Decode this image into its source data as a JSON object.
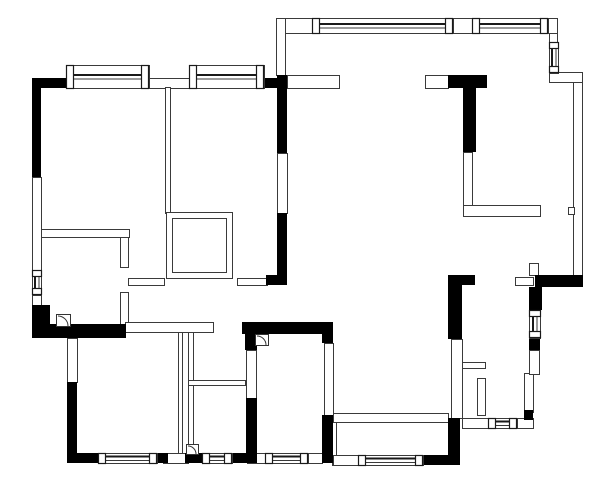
{
  "meta": {
    "kind": "architectural-floor-plan",
    "canvas": {
      "width": 600,
      "height": 483,
      "background": "#ffffff"
    },
    "colors": {
      "structural_wall": "#000000",
      "partition_line": "#3a3a3a",
      "window_glass": "#1a1a1a",
      "paper": "#ffffff"
    }
  },
  "floorplan": {
    "black_walls": [
      [
        32,
        78,
        9,
        99
      ],
      [
        32,
        78,
        36,
        10
      ],
      [
        263,
        78,
        20,
        10
      ],
      [
        277,
        75,
        10,
        78
      ],
      [
        277,
        213,
        10,
        72
      ],
      [
        266,
        275,
        21,
        10
      ],
      [
        448,
        75,
        39,
        13
      ],
      [
        463,
        88,
        13,
        64
      ],
      [
        32,
        305,
        18,
        33
      ],
      [
        32,
        324,
        94,
        14
      ],
      [
        242,
        322,
        91,
        12
      ],
      [
        245,
        334,
        12,
        16
      ],
      [
        246,
        398,
        11,
        65
      ],
      [
        322,
        334,
        11,
        9
      ],
      [
        322,
        415,
        11,
        48
      ],
      [
        67,
        382,
        10,
        81
      ],
      [
        67,
        453,
        31,
        10
      ],
      [
        157,
        453,
        11,
        10
      ],
      [
        185,
        453,
        17,
        10
      ],
      [
        232,
        453,
        15,
        10
      ],
      [
        448,
        275,
        27,
        10
      ],
      [
        448,
        275,
        14,
        64
      ],
      [
        448,
        418,
        12,
        47
      ],
      [
        423,
        455,
        35,
        10
      ],
      [
        535,
        275,
        48,
        12
      ],
      [
        529,
        287,
        13,
        23
      ],
      [
        529,
        338,
        11,
        12
      ],
      [
        524,
        410,
        9,
        10
      ]
    ],
    "thin_walls": [
      [
        32,
        177,
        9,
        94
      ],
      [
        32,
        295,
        9,
        12
      ],
      [
        148,
        78,
        42,
        10
      ],
      [
        165,
        87,
        5,
        126
      ],
      [
        166,
        212,
        66,
        66
      ],
      [
        172,
        218,
        54,
        54
      ],
      [
        41,
        229,
        88,
        8
      ],
      [
        120,
        237,
        8,
        30
      ],
      [
        120,
        292,
        8,
        33
      ],
      [
        128,
        278,
        36,
        7
      ],
      [
        237,
        278,
        30,
        7
      ],
      [
        276,
        18,
        36,
        15
      ],
      [
        276,
        18,
        9,
        57
      ],
      [
        453,
        18,
        19,
        15
      ],
      [
        548,
        18,
        9,
        15
      ],
      [
        549,
        33,
        8,
        10
      ],
      [
        549,
        72,
        33,
        10
      ],
      [
        573,
        82,
        9,
        194
      ],
      [
        568,
        207,
        6,
        7
      ],
      [
        287,
        75,
        52,
        13
      ],
      [
        425,
        75,
        23,
        13
      ],
      [
        463,
        152,
        9,
        56
      ],
      [
        463,
        205,
        77,
        11
      ],
      [
        277,
        153,
        10,
        60
      ],
      [
        125,
        322,
        88,
        10
      ],
      [
        188,
        332,
        5,
        125
      ],
      [
        188,
        380,
        57,
        5
      ],
      [
        178,
        332,
        4,
        125
      ],
      [
        163,
        453,
        25,
        10
      ],
      [
        247,
        453,
        18,
        10
      ],
      [
        308,
        453,
        14,
        10
      ],
      [
        333,
        413,
        115,
        9
      ],
      [
        332,
        422,
        4,
        43
      ],
      [
        333,
        455,
        25,
        10
      ],
      [
        458,
        362,
        27,
        6
      ],
      [
        451,
        339,
        11,
        79
      ],
      [
        477,
        378,
        8,
        37
      ],
      [
        524,
        373,
        9,
        39
      ],
      [
        462,
        418,
        71,
        10
      ],
      [
        529,
        350,
        10,
        24
      ],
      [
        515,
        277,
        18,
        8
      ],
      [
        529,
        263,
        9,
        12
      ],
      [
        67,
        338,
        10,
        44
      ],
      [
        246,
        350,
        10,
        48
      ],
      [
        324,
        343,
        9,
        72
      ]
    ],
    "windows": [
      {
        "x": 66,
        "y": 65,
        "w": 83,
        "h": 23,
        "orient": "h"
      },
      {
        "x": 189,
        "y": 65,
        "w": 75,
        "h": 23,
        "orient": "h"
      },
      {
        "x": 312,
        "y": 18,
        "w": 141,
        "h": 15,
        "orient": "h"
      },
      {
        "x": 472,
        "y": 18,
        "w": 76,
        "h": 15,
        "orient": "h"
      },
      {
        "x": 549,
        "y": 42,
        "w": 9,
        "h": 31,
        "orient": "v"
      },
      {
        "x": 32,
        "y": 270,
        "w": 9,
        "h": 25,
        "orient": "v"
      },
      {
        "x": 98,
        "y": 453,
        "w": 59,
        "h": 10,
        "orient": "h"
      },
      {
        "x": 202,
        "y": 453,
        "w": 30,
        "h": 10,
        "orient": "h"
      },
      {
        "x": 265,
        "y": 453,
        "w": 43,
        "h": 10,
        "orient": "h"
      },
      {
        "x": 358,
        "y": 455,
        "w": 65,
        "h": 10,
        "orient": "h"
      },
      {
        "x": 488,
        "y": 418,
        "w": 29,
        "h": 10,
        "orient": "h"
      },
      {
        "x": 529,
        "y": 310,
        "w": 11,
        "h": 28,
        "orient": "v"
      }
    ],
    "door_arcs": [
      {
        "x": 56,
        "y": 314,
        "s": 14
      },
      {
        "x": 255,
        "y": 334,
        "s": 13
      },
      {
        "x": 186,
        "y": 444,
        "s": 12
      }
    ]
  }
}
